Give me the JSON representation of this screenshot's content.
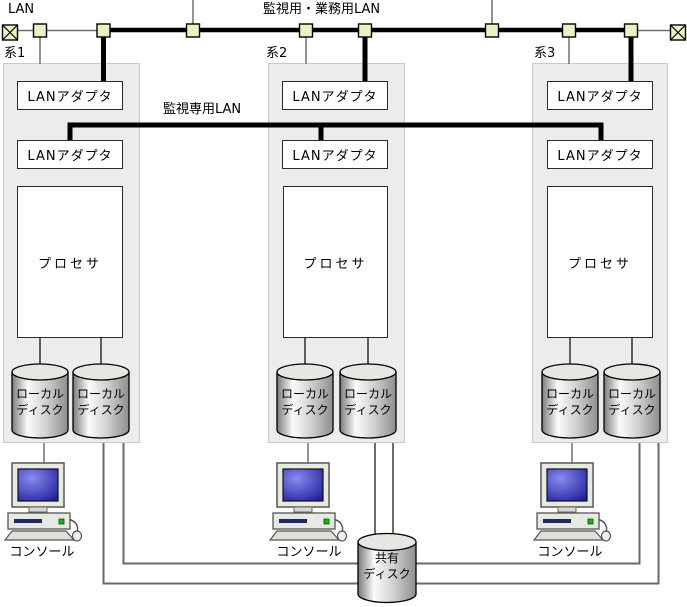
{
  "labels": {
    "lan": "LAN",
    "business_lan": "監視用・業務用LAN",
    "monitoring_lan": "監視専用LAN"
  },
  "systems": [
    {
      "name": "系1",
      "lan_adapter_top": "LANアダプタ",
      "lan_adapter_bottom": "LANアダプタ",
      "processor": "プロセサ",
      "local_disks": [
        [
          "ローカル",
          "ディスク"
        ],
        [
          "ローカル",
          "ディスク"
        ]
      ],
      "console": "コンソール"
    },
    {
      "name": "系2",
      "lan_adapter_top": "LANアダプタ",
      "lan_adapter_bottom": "LANアダプタ",
      "processor": "プロセサ",
      "local_disks": [
        [
          "ローカル",
          "ディスク"
        ],
        [
          "ローカル",
          "ディスク"
        ]
      ],
      "console": "コンソール"
    },
    {
      "name": "系3",
      "lan_adapter_top": "LANアダプタ",
      "lan_adapter_bottom": "LANアダプタ",
      "processor": "プロセサ",
      "local_disks": [
        [
          "ローカル",
          "ディスク"
        ],
        [
          "ローカル",
          "ディスク"
        ]
      ],
      "console": "コンソール"
    }
  ],
  "shared_disk": [
    "共有",
    "ディスク"
  ],
  "colors": {
    "tap_fill": "#efefc6",
    "bus_line": "#000000",
    "thin_line": "#707070",
    "system_box_fill": "#ececec",
    "loop_line": "#6a6a6a",
    "console_screen": "#2323a8",
    "disk_body_mid": "#f8f8f8"
  }
}
